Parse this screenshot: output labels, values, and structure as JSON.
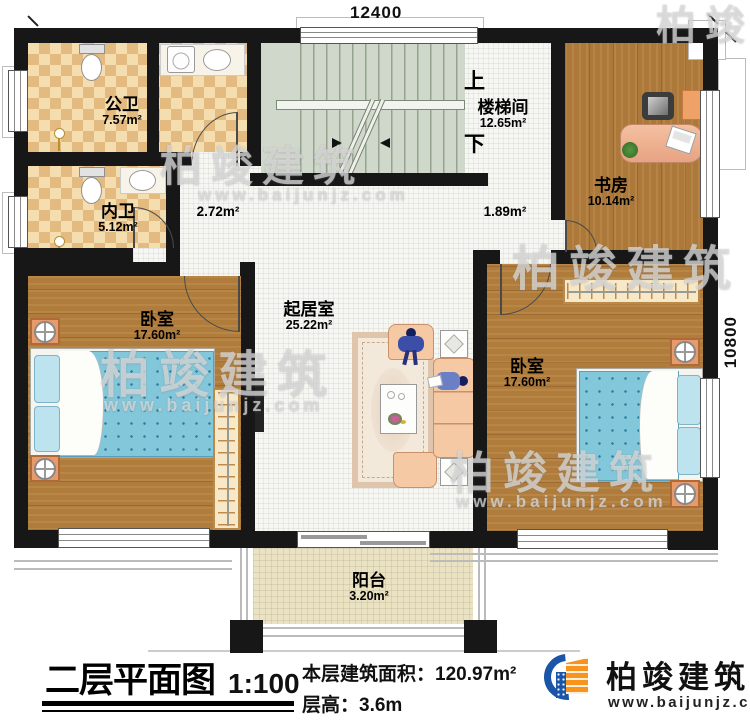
{
  "plan": {
    "dimension_top": "12400",
    "dimension_right": "10800",
    "rooms": {
      "public_bath": {
        "name": "公卫",
        "area": "7.57m²"
      },
      "inner_bath": {
        "name": "内卫",
        "area": "5.12m²"
      },
      "stairwell": {
        "name": "楼梯间",
        "area": "12.65m²"
      },
      "study": {
        "name": "书房",
        "area": "10.14m²"
      },
      "bedroom_left": {
        "name": "卧室",
        "area": "17.60m²"
      },
      "living": {
        "name": "起居室",
        "area": "25.22m²"
      },
      "bedroom_right": {
        "name": "卧室",
        "area": "17.60m²"
      },
      "balcony": {
        "name": "阳台",
        "area": "3.20m²"
      }
    },
    "stair_labels": {
      "up": "上",
      "down": "下"
    },
    "hall_areas": {
      "left": "2.72m²",
      "right": "1.89m²"
    }
  },
  "title_block": {
    "title": "二层平面图",
    "scale": "1:100",
    "area_label": "本层建筑面积：",
    "area_value": "120.97m²",
    "height_label": "层高：",
    "height_value": "3.6m"
  },
  "brand": {
    "name": "柏竣建筑",
    "website": "www.baijunjz.com"
  },
  "watermark": {
    "text": "柏竣建筑",
    "website": "www.baijunjz.com"
  },
  "colors": {
    "wall": "#171717",
    "wood": "#b07c3c",
    "bath_tile": "#e3ba80",
    "stairs": "#cfd8ca",
    "balcony": "#ebe2c2",
    "bed": "#83c7da",
    "accent_orange": "#e89a6b",
    "logo_blue": "#1b55a8",
    "logo_orange": "#f7941d"
  }
}
